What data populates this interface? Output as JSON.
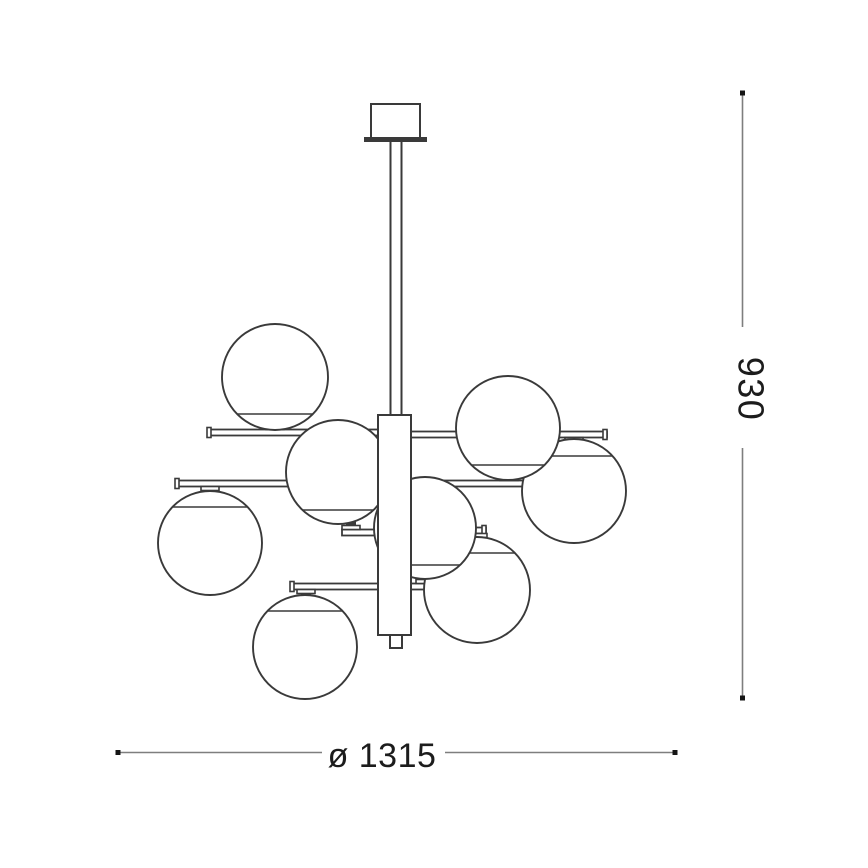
{
  "canvas": {
    "width": 868,
    "height": 868,
    "background": "#ffffff"
  },
  "style": {
    "outline_color": "#3a3a3a",
    "dimension_line_color": "#7e7e7e",
    "label_color": "#1c1c1c"
  },
  "fixture": {
    "kind": "suspension chandelier technical drawing",
    "globe_count": 8
  },
  "dimensions": {
    "height": {
      "label": "930",
      "orientation": "vertical"
    },
    "diameter": {
      "label": "ø 1315",
      "orientation": "horizontal"
    }
  }
}
